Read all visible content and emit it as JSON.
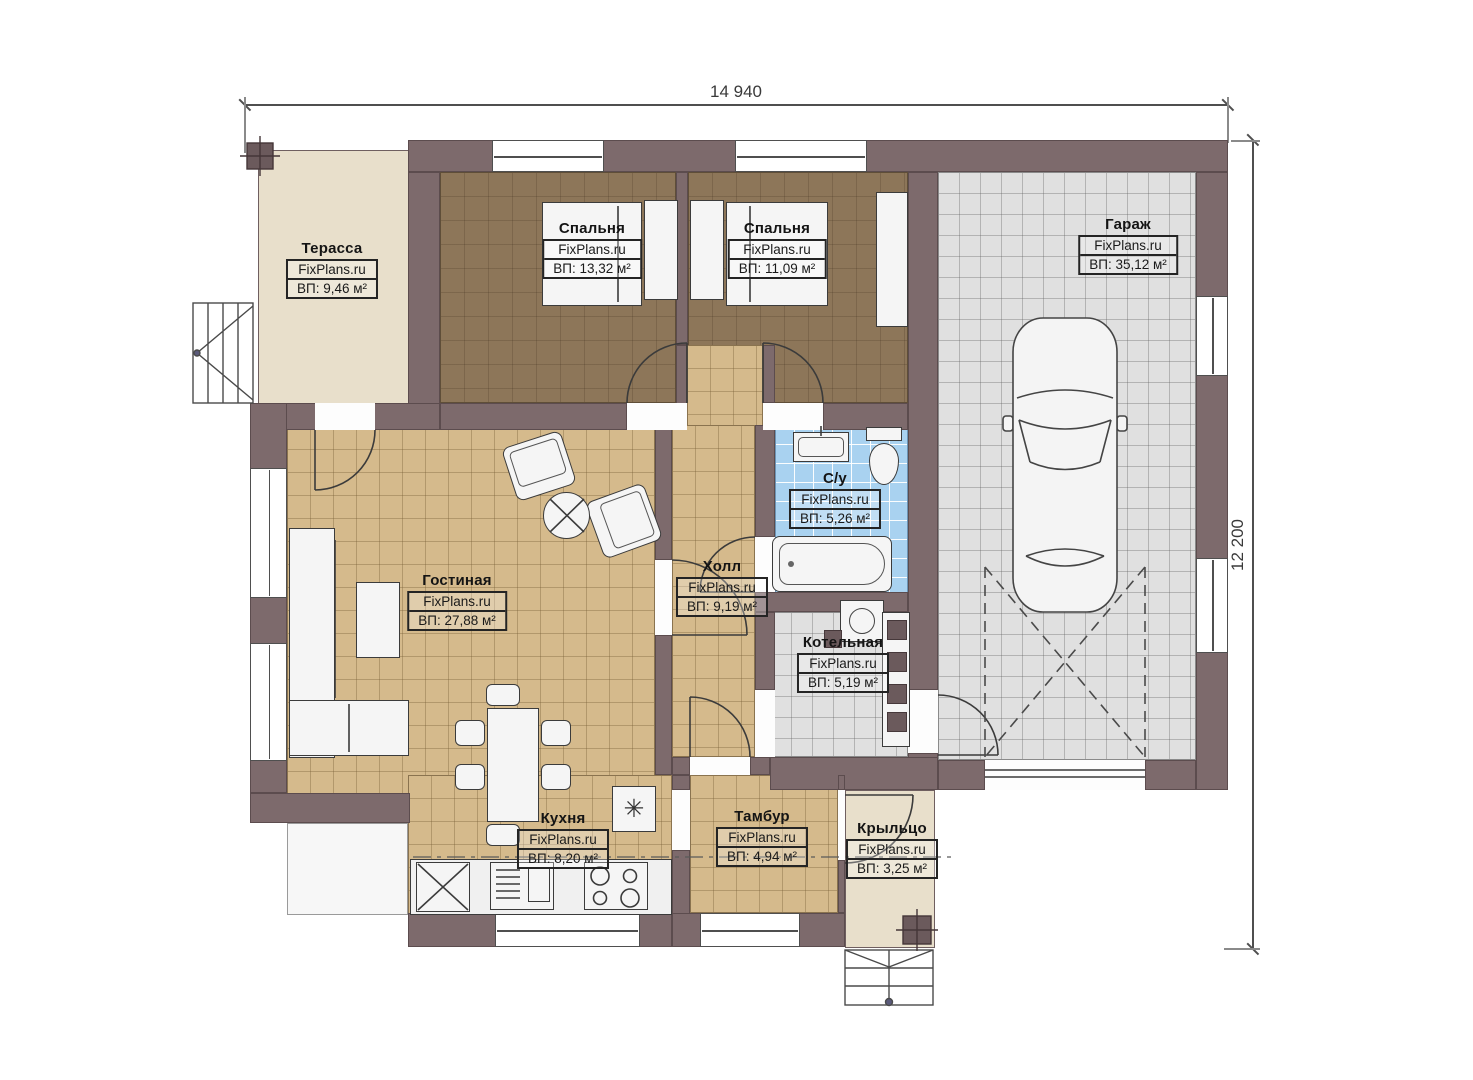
{
  "brand": "FixPlans.ru",
  "dimensions": {
    "width": "14 940",
    "height": "12 200"
  },
  "rooms": [
    {
      "key": "terrace",
      "name": "Терасса",
      "brand": "FixPlans.ru",
      "area": "ВП: 9,46 м²"
    },
    {
      "key": "bedroom-1",
      "name": "Спальня",
      "brand": "FixPlans.ru",
      "area": "ВП: 13,32 м²"
    },
    {
      "key": "bedroom-2",
      "name": "Спальня",
      "brand": "FixPlans.ru",
      "area": "ВП: 11,09 м²"
    },
    {
      "key": "garage",
      "name": "Гараж",
      "brand": "FixPlans.ru",
      "area": "ВП: 35,12 м²"
    },
    {
      "key": "bathroom",
      "name": "С/у",
      "brand": "FixPlans.ru",
      "area": "ВП: 5,26 м²"
    },
    {
      "key": "hall",
      "name": "Холл",
      "brand": "FixPlans.ru",
      "area": "ВП: 9,19 м²"
    },
    {
      "key": "living-room",
      "name": "Гостиная",
      "brand": "FixPlans.ru",
      "area": "ВП: 27,88 м²"
    },
    {
      "key": "boiler-room",
      "name": "Котельная",
      "brand": "FixPlans.ru",
      "area": "ВП: 5,19 м²"
    },
    {
      "key": "kitchen",
      "name": "Кухня",
      "brand": "FixPlans.ru",
      "area": "ВП: 8,20 м²"
    },
    {
      "key": "vestibule",
      "name": "Тамбур",
      "brand": "FixPlans.ru",
      "area": "ВП: 4,94 м²"
    },
    {
      "key": "porch",
      "name": "Крыльцо",
      "brand": "FixPlans.ru",
      "area": "ВП: 3,25 м²"
    }
  ],
  "symbols": {
    "fridge": "✳"
  },
  "colors": {
    "wall": "#7d6a6c",
    "floor_tan": "#d5ba8c",
    "floor_brown": "#8d7659",
    "floor_gray": "#e0e0e0",
    "floor_blue": "#a9d2f0",
    "floor_beige": "#e8dfcb",
    "linework": "#3b3b3b"
  }
}
